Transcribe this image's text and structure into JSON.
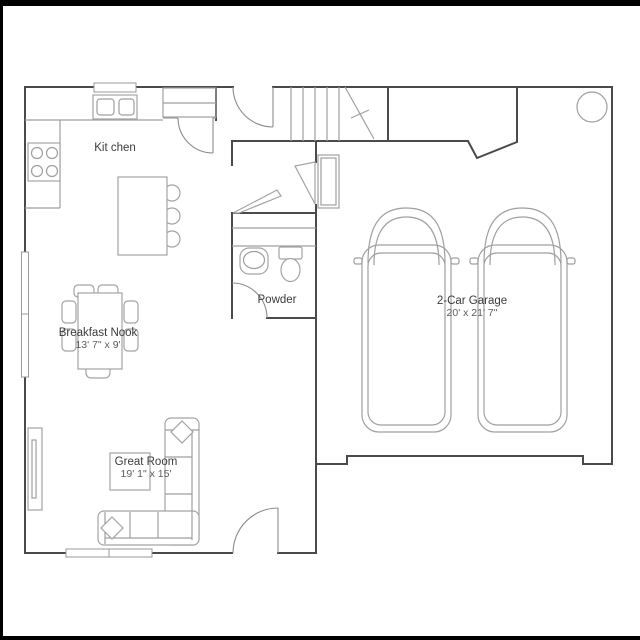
{
  "document": {
    "kind": "residential first-floor plan",
    "background_color": "#ffffff",
    "wall_color": "#4a4a4a",
    "furniture_color": "#a3a3a3",
    "text_color": "#3b3b3b",
    "dimension_text_color": "#5d5d5d",
    "letterbox_color": "#000000"
  },
  "rooms": {
    "kitchen": {
      "label": "Kit chen"
    },
    "breakfast_nook": {
      "label": "Breakfast Nook",
      "dimensions": "13' 7\" x 9'"
    },
    "powder": {
      "label": "Powder"
    },
    "great_room": {
      "label": "Great Room",
      "dimensions": "19' 1\" x 15'"
    },
    "garage": {
      "label": "2-Car Garage",
      "dimensions": "20' x 21' 7\""
    }
  },
  "symbols": [
    "stove",
    "double-sink",
    "kitchen-island-with-stools",
    "pantry",
    "dining-table-with-chairs",
    "sectional-sofa",
    "coffee-table",
    "fireplace-media-unit",
    "toilet",
    "vanity-sink",
    "stairs",
    "two-cars",
    "water-heater",
    "windows",
    "door-swings"
  ]
}
